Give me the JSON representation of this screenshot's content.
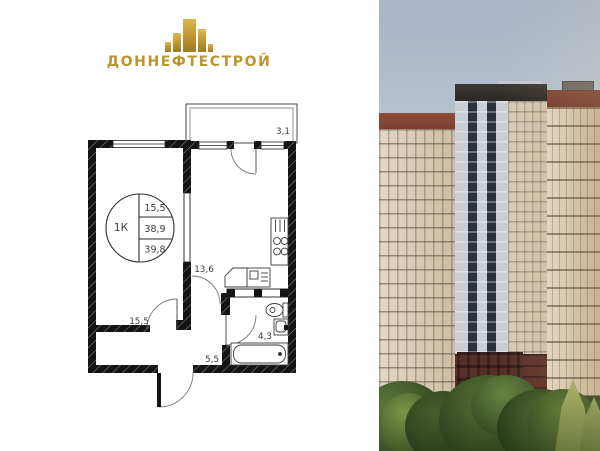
{
  "brand": {
    "name": "ДОННЕФТЕСТРОЙ",
    "accent_color": "#bb952e",
    "icon": "building-towers-icon"
  },
  "floor_plan": {
    "summary_circle": {
      "rooms_label": "1К",
      "living_area": "15,5",
      "area_without_balcony": "38,9",
      "total_area": "39,8"
    },
    "room_areas": {
      "bedroom": "15,5",
      "kitchen_living": "13,6",
      "hallway": "5,5",
      "bathroom": "4,3",
      "balcony": "3,1"
    }
  },
  "photo": {
    "alt": "residential-complex-rendering"
  },
  "colors": {
    "wall": "#141414",
    "plan_line": "#3a3a3a",
    "label_text": "#3c3c3c",
    "sky_top": "#a7b5c8",
    "brick": "#7c4334",
    "facade": "#d8cec0",
    "trees": "#2c3f20",
    "logo_gold": "#bb952e"
  }
}
